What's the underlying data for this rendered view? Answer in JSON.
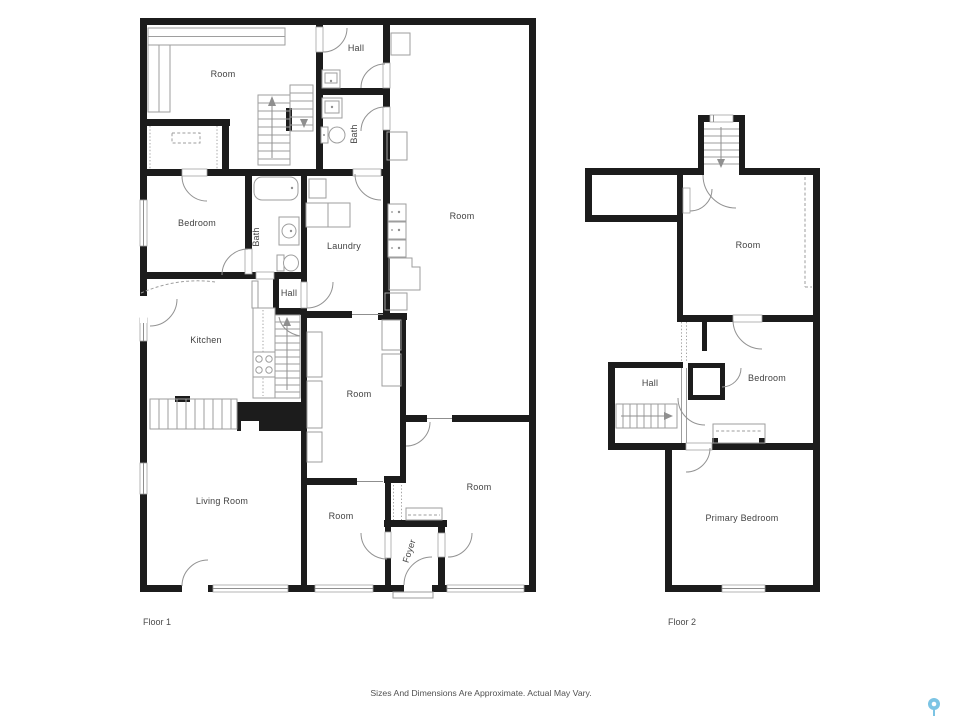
{
  "floor1": {
    "name": "Floor 1",
    "rooms": {
      "room_top_left": "Room",
      "hall_top": "Hall",
      "bath_top": "Bath",
      "room_right": "Room",
      "bedroom": "Bedroom",
      "bath_mid": "Bath",
      "laundry": "Laundry",
      "hall_mid": "Hall",
      "kitchen": "Kitchen",
      "room_mid": "Room",
      "living_room": "Living Room",
      "room_bottom_mid": "Room",
      "room_bottom_right": "Room",
      "foyer": "Foyer"
    }
  },
  "floor2": {
    "name": "Floor 2",
    "rooms": {
      "room": "Room",
      "hall": "Hall",
      "bedroom": "Bedroom",
      "primary_bedroom": "Primary Bedroom"
    }
  },
  "footer": {
    "disclaimer": "Sizes And Dimensions Are Approximate. Actual May Vary."
  },
  "icons": {
    "map_pin_color": "#7cc4e4"
  },
  "colors": {
    "wall": "#1c1c1c",
    "line": "#9e9e9e",
    "text": "#424242",
    "background": "#ffffff"
  }
}
